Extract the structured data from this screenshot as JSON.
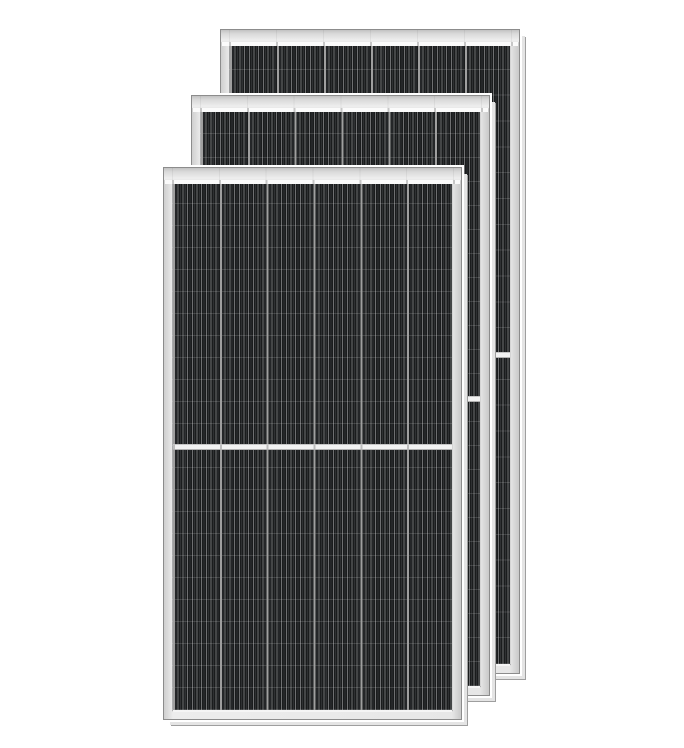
{
  "image": {
    "type": "product-photo",
    "subject": "Three black monocrystalline half-cut solar panel modules with silver aluminum frames, overlapping diagonally front-to-back on a white background",
    "visible_text": ""
  },
  "colors": {
    "background": "#ffffff",
    "frame_face": "#e9e9e9",
    "frame_outline": "#8c8c8c",
    "glass_edge_strip": "#fbfbfb",
    "cell_black": "#1f2123",
    "cell_grid_line": "#9f9f9f",
    "center_gap": "#f2f2f2",
    "edge_extrusion": "#e4e4e4",
    "halo": "#ffffff"
  },
  "panels": [
    {
      "name": "solar-panel-back",
      "x": 220,
      "y": 29,
      "width": 300,
      "height": 645,
      "columns": 6,
      "rows": 24,
      "half_cut": true
    },
    {
      "name": "solar-panel-middle",
      "x": 191,
      "y": 95,
      "width": 299,
      "height": 601,
      "columns": 6,
      "rows": 24,
      "half_cut": true
    },
    {
      "name": "solar-panel-front",
      "x": 163,
      "y": 167,
      "width": 299,
      "height": 553,
      "columns": 6,
      "rows": 24,
      "half_cut": true
    }
  ]
}
